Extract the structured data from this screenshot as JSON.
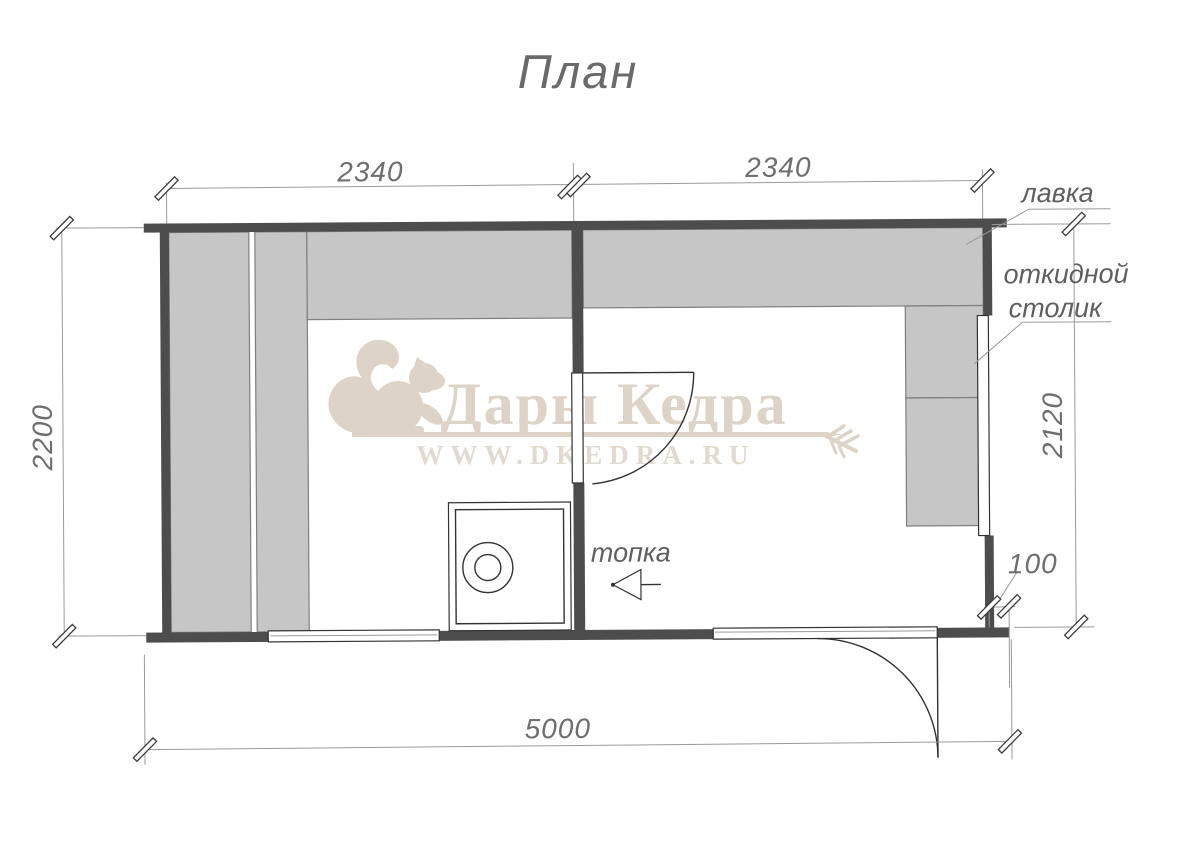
{
  "title": "План",
  "plan": {
    "labels": {
      "bench": "лавка",
      "folding_table_line1": "откидной",
      "folding_table_line2": "столик",
      "firebox": "топка"
    },
    "dimensions": {
      "top_left": "2340",
      "top_right": "2340",
      "left": "2200",
      "right": "2120",
      "offset": "100",
      "bottom": "5000"
    }
  },
  "watermark": {
    "brand": "Дары Кедра",
    "site": "WWW.DKEDRA.RU"
  },
  "colors": {
    "wall": "#4d4d4d",
    "bench": "#c6c6c6",
    "bench_edge": "#7f7f7f",
    "line": "#333333",
    "dim": "#9a9a9a",
    "dim_text": "#6e6e6e",
    "label_text": "#5f5f5f",
    "watermark": "#ddd3c6",
    "site_text": "#e2dace"
  }
}
